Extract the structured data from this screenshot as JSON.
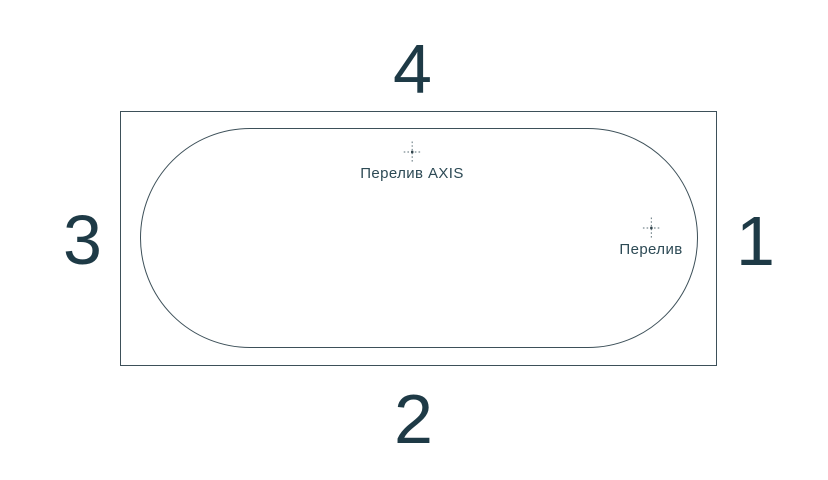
{
  "diagram": {
    "title": "Bathtub top-view scheme with numbered sides",
    "sides": {
      "top": "4",
      "right": "1",
      "bottom": "2",
      "left": "3"
    },
    "markers": {
      "overflow_axis": {
        "label": "Перелив AXIS"
      },
      "overflow": {
        "label": "Перелив"
      }
    },
    "colors": {
      "background": "#ffffff",
      "outline": "#3d5059",
      "number_text": "#1e3a46",
      "label_text": "#2d4a55",
      "crosshair_dots": "#7b8b91",
      "crosshair_center": "#32454d"
    }
  }
}
